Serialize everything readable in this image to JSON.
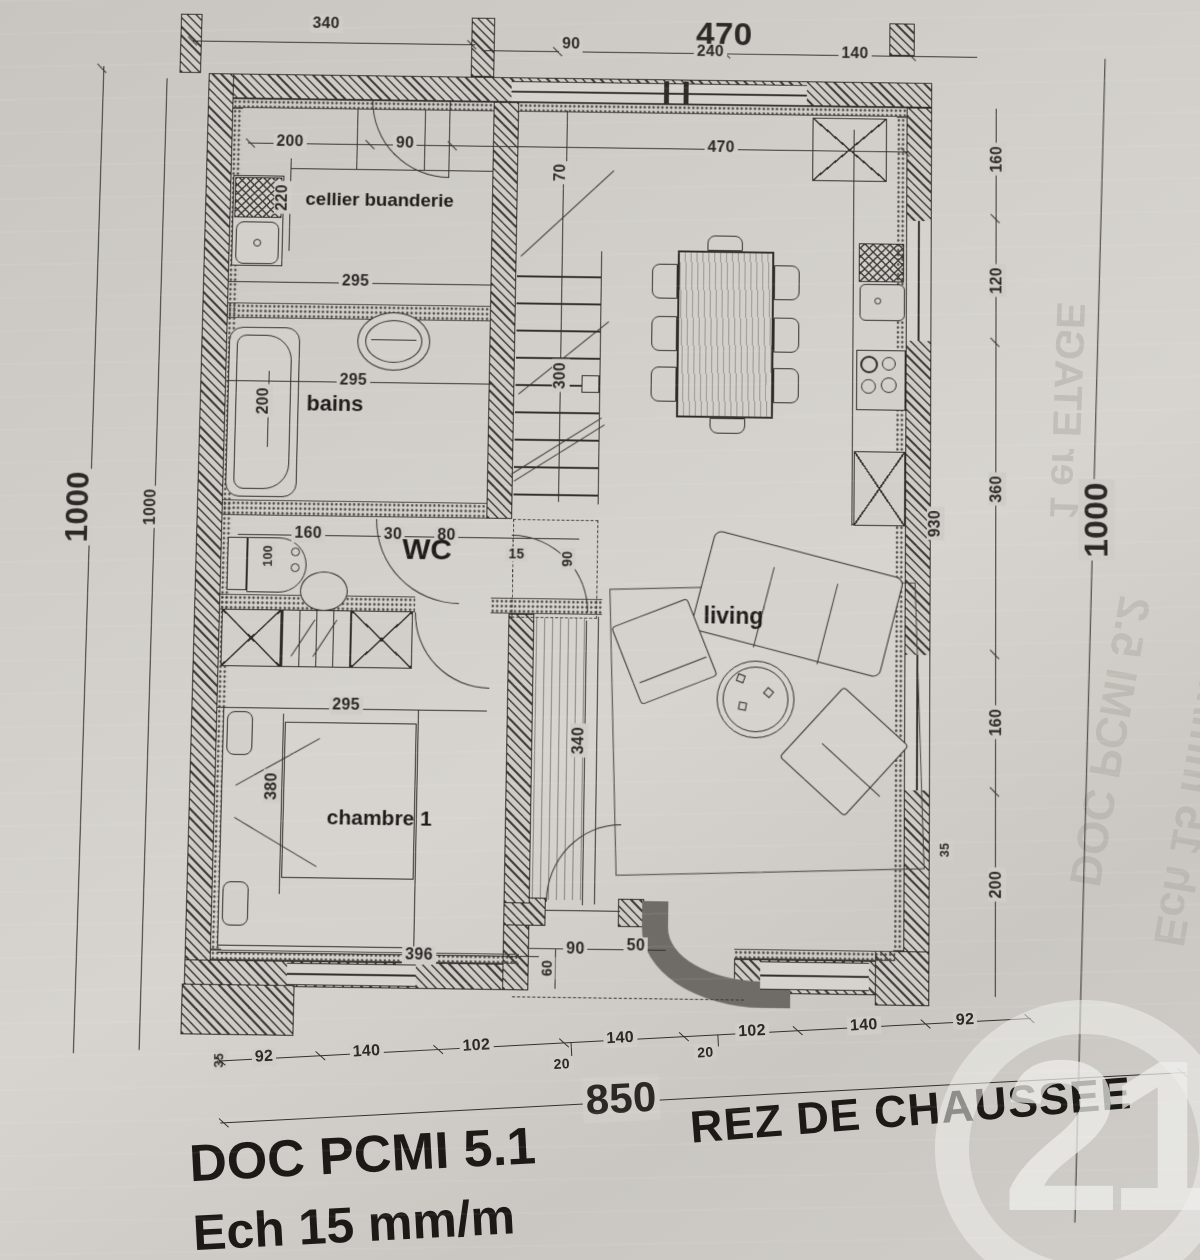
{
  "sheet": {
    "floor_title": "REZ DE CHAUSSEE",
    "doc_ref": "DOC PCMI 5.1",
    "scale": "Ech 15 mm/m"
  },
  "rooms": {
    "cellier": "cellier buanderie",
    "bains": "bains",
    "wc": "WC",
    "chambre": "chambre 1",
    "living": "living"
  },
  "dims": {
    "top": [
      "340",
      "90",
      "470",
      "240",
      "140"
    ],
    "upper": [
      "200",
      "90",
      "70",
      "470",
      "160"
    ],
    "left": [
      "1000",
      "1000"
    ],
    "right": [
      "120",
      "360",
      "160",
      "200",
      "930",
      "1000",
      "35"
    ],
    "cellier": [
      "220",
      "295"
    ],
    "bains": [
      "295",
      "200"
    ],
    "stairs": [
      "300"
    ],
    "wc": [
      "160",
      "100",
      "30",
      "80",
      "15",
      "90"
    ],
    "living": [
      "340"
    ],
    "chambre": [
      "295",
      "380",
      "396",
      "35"
    ],
    "porch": [
      "90",
      "60",
      "50"
    ],
    "bottom": [
      "92",
      "140",
      "102",
      "20",
      "140",
      "20",
      "102",
      "140",
      "92"
    ],
    "overall": [
      "850"
    ]
  },
  "ghost": {
    "etage": "1 er ETAGE",
    "doc": "DOC PCMI 5.2",
    "scale": "Ech 15 mm/m"
  },
  "logo": {
    "number": "21"
  }
}
